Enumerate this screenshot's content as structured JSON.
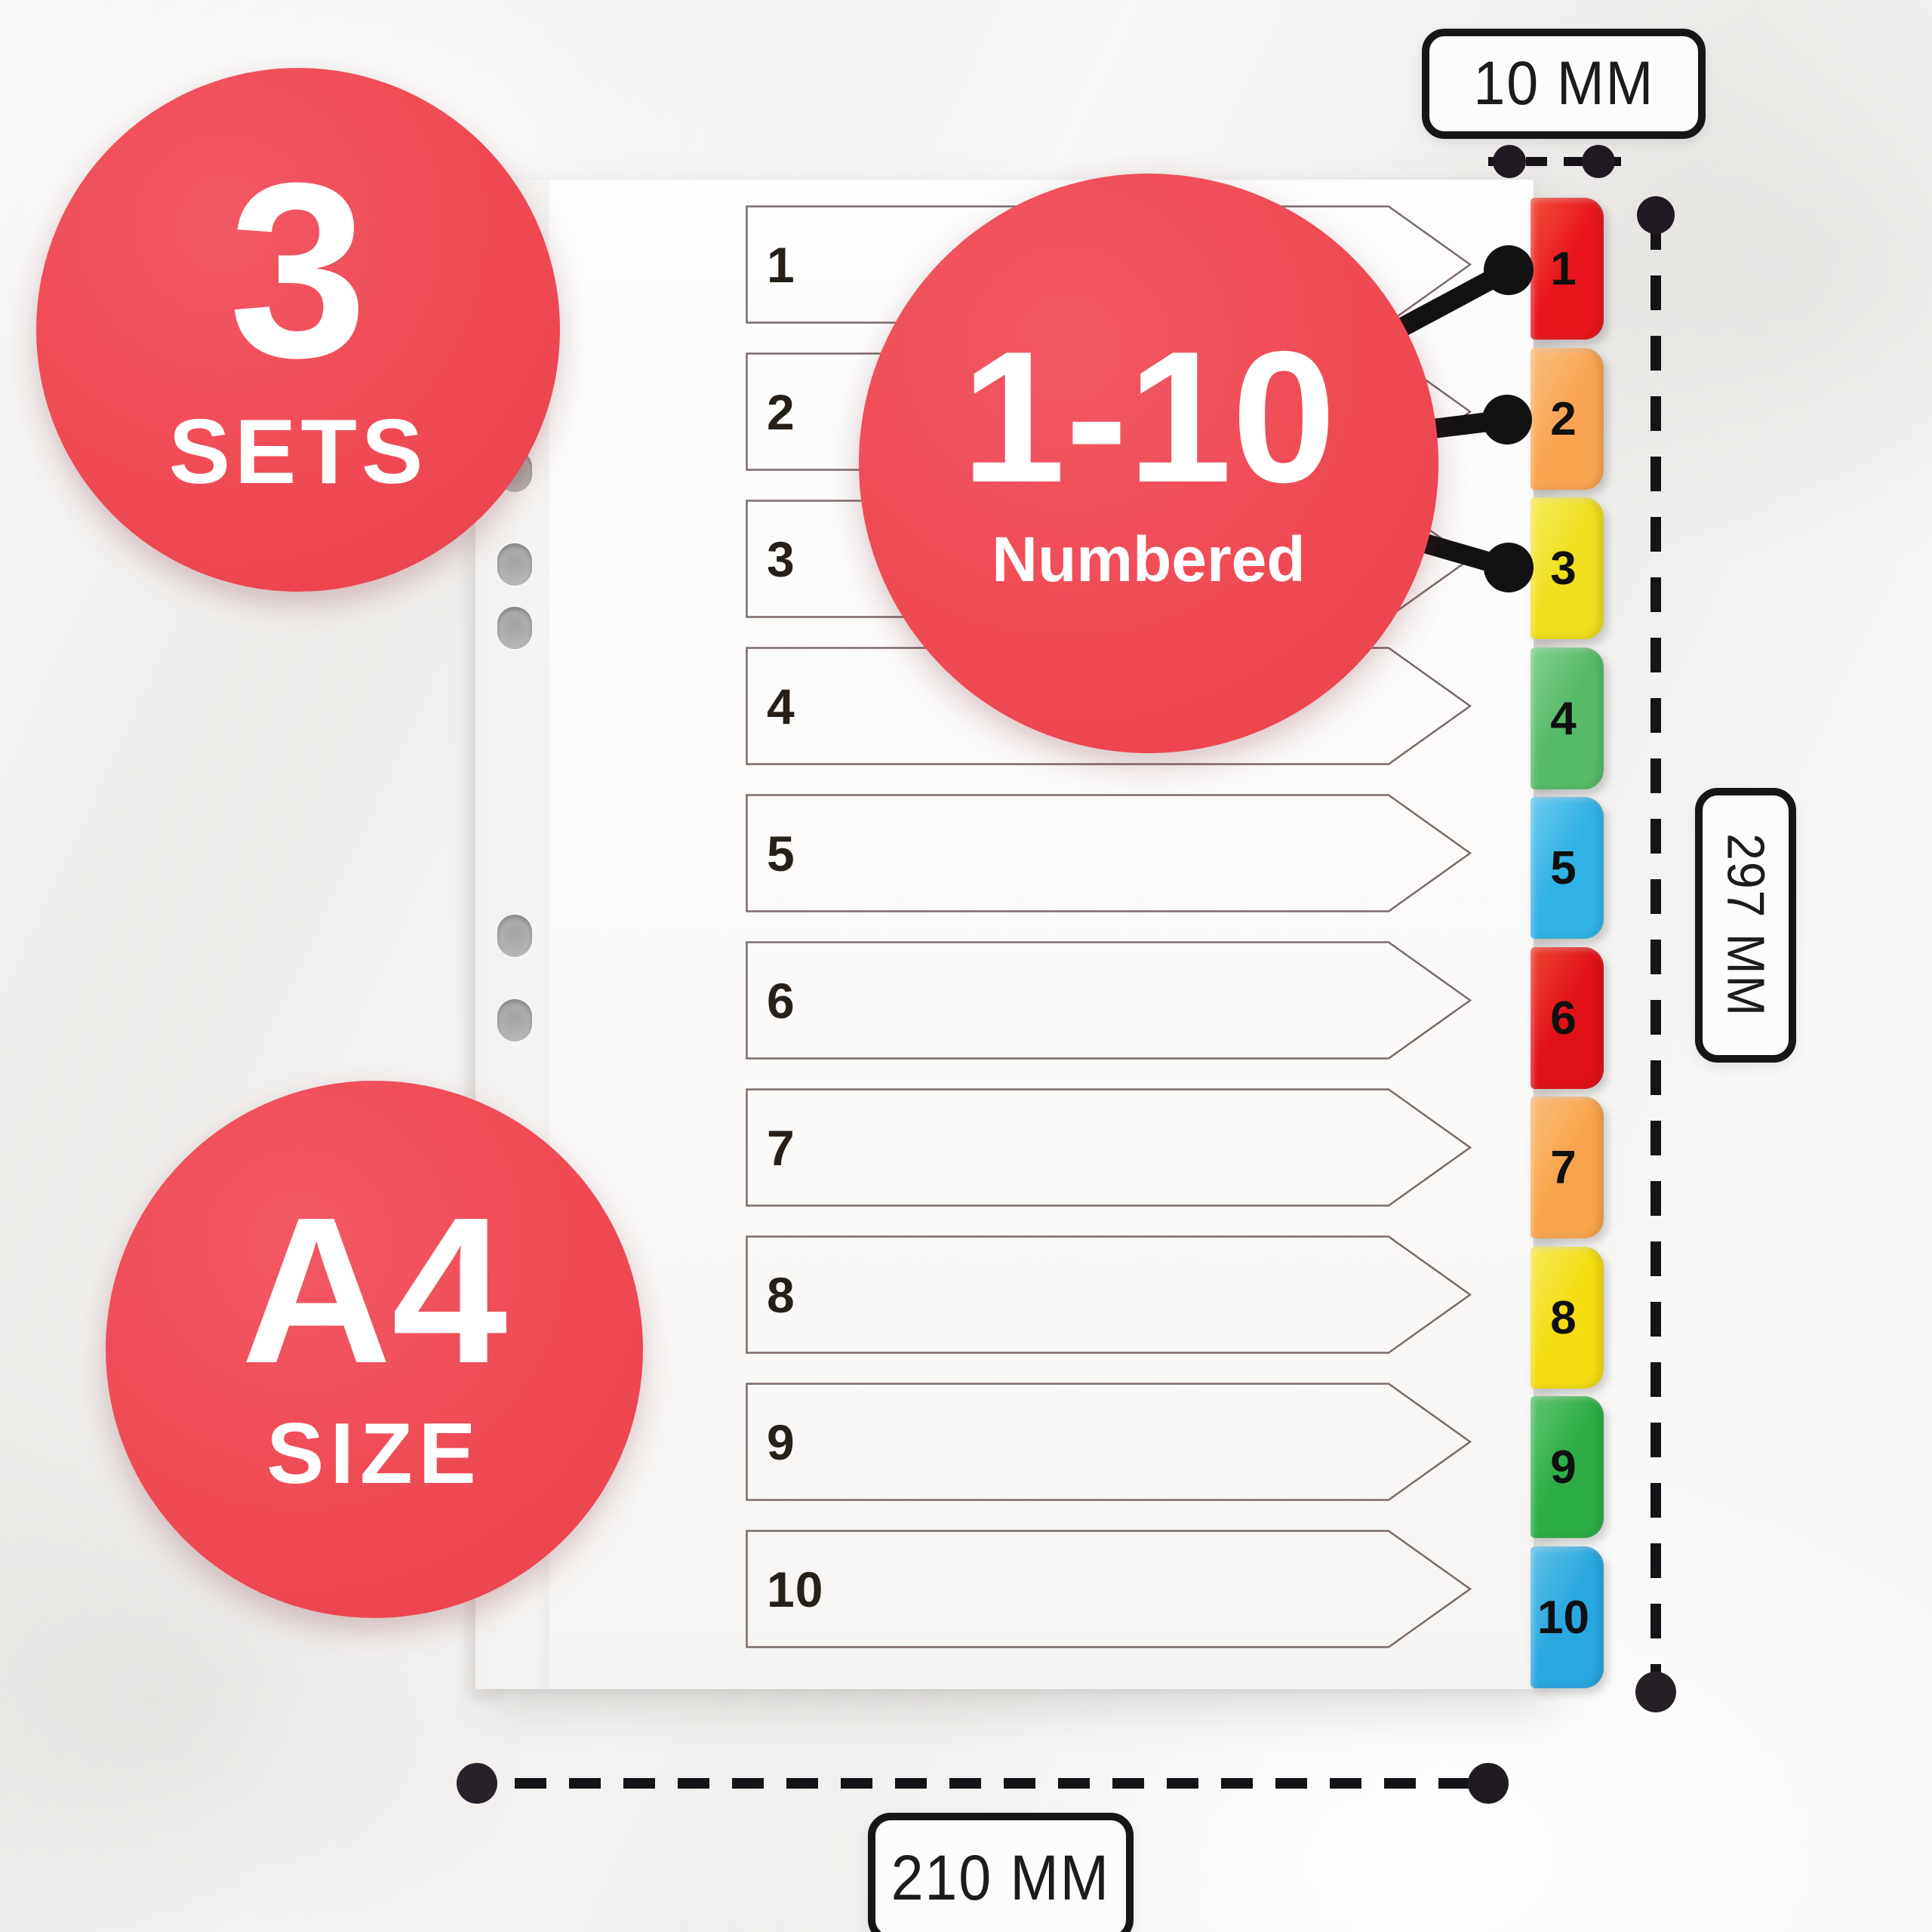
{
  "badges": {
    "sets": {
      "value": "3",
      "label": "SETS"
    },
    "numbered": {
      "value": "1-10",
      "label": "Numbered"
    },
    "size": {
      "value": "A4",
      "label": "SIZE"
    }
  },
  "dimensions": {
    "tab_width": "10 MM",
    "sheet_height": "297 MM",
    "sheet_width": "210 MM"
  },
  "divider": {
    "rows": [
      "1",
      "2",
      "3",
      "4",
      "5",
      "6",
      "7",
      "8",
      "9",
      "10"
    ],
    "tabs": [
      {
        "label": "1",
        "color": "#e8151d",
        "color_light": "#f4503f"
      },
      {
        "label": "2",
        "color": "#f9a451",
        "color_light": "#fbbf80"
      },
      {
        "label": "3",
        "color": "#f0df1e",
        "color_light": "#f7ec5e"
      },
      {
        "label": "4",
        "color": "#56bb68",
        "color_light": "#82d190"
      },
      {
        "label": "5",
        "color": "#30b2e7",
        "color_light": "#6fcaf0"
      },
      {
        "label": "6",
        "color": "#e01119",
        "color_light": "#ef4536"
      },
      {
        "label": "7",
        "color": "#f9a44c",
        "color_light": "#fbbe7c"
      },
      {
        "label": "8",
        "color": "#f4dd12",
        "color_light": "#f8e95a"
      },
      {
        "label": "9",
        "color": "#2dad45",
        "color_light": "#5fc571"
      },
      {
        "label": "10",
        "color": "#28a7e0",
        "color_light": "#65c2ea"
      }
    ]
  },
  "colors": {
    "badge_red": "#ef4a54",
    "annotation_black": "#151318",
    "dot_dark": "#211a22",
    "row_border": "#7d6a6a"
  }
}
